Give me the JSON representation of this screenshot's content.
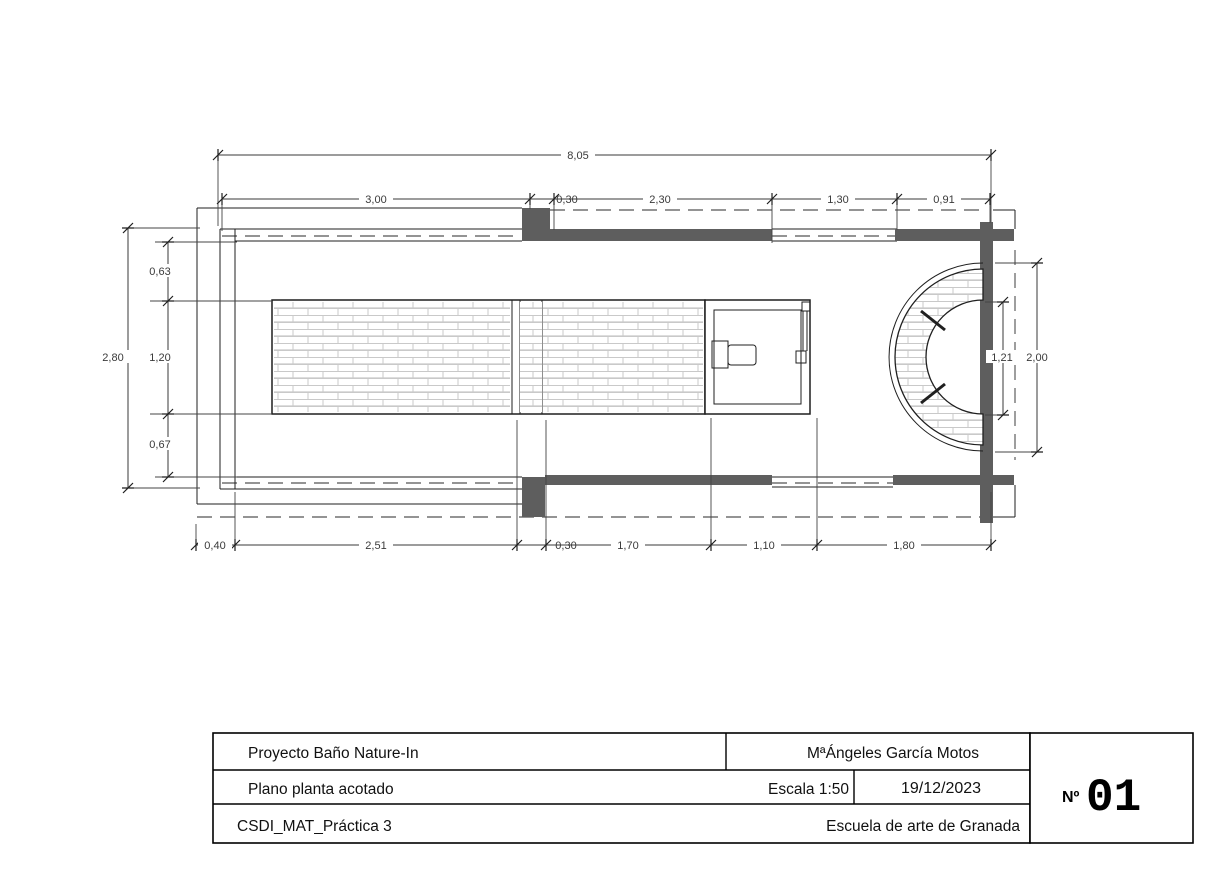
{
  "drawing": {
    "type": "architectural-floor-plan",
    "dims": {
      "total_width": "8,05",
      "top_segments": [
        "3,00",
        "0,30",
        "2,30",
        "1,30",
        "0,91"
      ],
      "left_total": "2,80",
      "left_segments": [
        "0,63",
        "1,20",
        "0,67"
      ],
      "right_inner": "1,21",
      "right_outer": "2,00",
      "bottom_segments": [
        "0,40",
        "2,51",
        "0,30",
        "1,70",
        "1,10",
        "1,80"
      ]
    },
    "colors": {
      "wall_fill": "#5e5e5e",
      "line": "#1f1f1f",
      "dimension_text": "#3a3a3a",
      "brick_hatch": "#c9c9c9"
    }
  },
  "title_block": {
    "project": "Proyecto Baño Nature-In",
    "author": "MªÁngeles García Motos",
    "plan_name": "Plano planta acotado",
    "scale": "Escala 1:50",
    "date": "19/12/2023",
    "course": "CSDI_MAT_Práctica 3",
    "school": "Escuela de arte de Granada",
    "sheet_label": "Nº",
    "sheet_number": "01"
  }
}
